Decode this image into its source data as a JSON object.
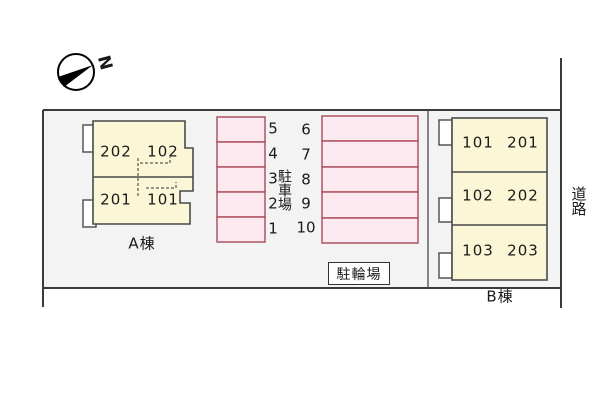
{
  "colors": {
    "site_fill": "#f3f3f3",
    "building_fill": "#fbf7d6",
    "building_stroke": "#4a4a4a",
    "stall_fill": "#fdeaf1",
    "stall_stroke": "#a84a58",
    "boundary_line": "#3a3a3a",
    "text": "#1a1a1a"
  },
  "compass": {
    "north_label": "N"
  },
  "building_a": {
    "name": "A棟",
    "units": [
      "202",
      "102",
      "201",
      "101"
    ]
  },
  "building_b": {
    "name": "B棟",
    "units": [
      "101",
      "201",
      "102",
      "202",
      "103",
      "203"
    ]
  },
  "parking": {
    "label": "駐車場",
    "left_numbers": [
      "5",
      "4",
      "3",
      "2",
      "1"
    ],
    "right_numbers": [
      "6",
      "7",
      "8",
      "9",
      "10"
    ]
  },
  "bicycle": {
    "label": "駐輪場"
  },
  "road": {
    "label": "道路"
  }
}
